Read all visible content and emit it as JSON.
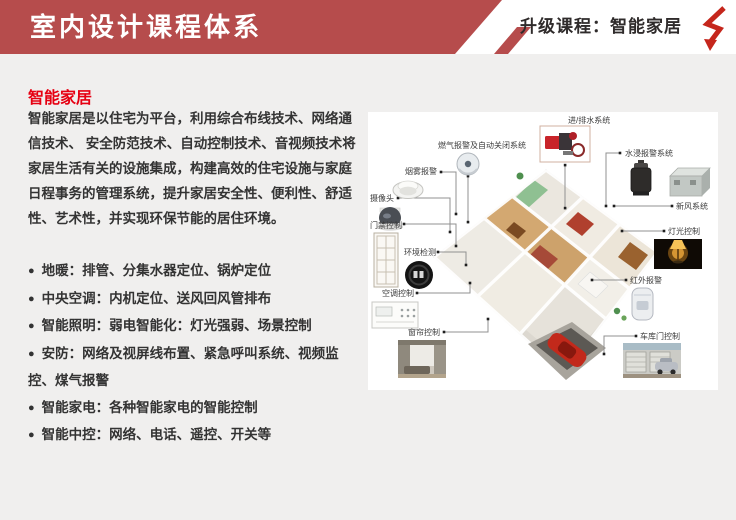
{
  "header": {
    "title": "室内设计课程体系",
    "subtitle": "升级课程：智能家居",
    "logo_icon": "red-zigzag-arrow-icon"
  },
  "content": {
    "heading": "智能家居",
    "paragraph": "智能家居是以住宅为平台，利用综合布线技术、网络通信技术、 安全防范技术、自动控制技术、音视频技术将家居生活有关的设施集成，构建高效的住宅设施与家庭日程事务的管理系统，提升家居安全性、便利性、舒适性、艺术性，并实现环保节能的居住环境。",
    "bullet_char": "●",
    "bullets": [
      "地暖：排管、分集水器定位、锅炉定位",
      "中央空调：内机定位、送风回风管排布",
      "智能照明：弱电智能化：灯光强弱、场景控制",
      "安防：网络及视屏线布置、紧急呼叫系统、视频监控、煤气报警",
      "智能家电：各种智能家电的智能控制",
      "智能中控：网络、电话、遥控、开关等"
    ]
  },
  "diagram": {
    "description": "smart-home-isometric-house",
    "callouts": [
      {
        "id": "water-system",
        "label": "进/排水系统",
        "icon": "water-pump-icon"
      },
      {
        "id": "gas-alarm",
        "label": "燃气报警及自动关闭系统",
        "icon": "gas-sensor-ball-icon"
      },
      {
        "id": "smoke-alarm",
        "label": "烟雾报警",
        "icon": "smoke-detector-icon"
      },
      {
        "id": "camera",
        "label": "摄像头",
        "icon": "dome-camera-icon"
      },
      {
        "id": "door-access",
        "label": "门禁控制",
        "icon": "door-icon"
      },
      {
        "id": "environment",
        "label": "环境检测",
        "icon": "thermostat-icon"
      },
      {
        "id": "ac-control",
        "label": "空调控制",
        "icon": "ac-panel-icon"
      },
      {
        "id": "curtain-control",
        "label": "窗帘控制",
        "icon": "curtain-photo-icon"
      },
      {
        "id": "water-leak",
        "label": "水浸报警系统",
        "icon": "canister-icon"
      },
      {
        "id": "fresh-air",
        "label": "新风系统",
        "icon": "ventilation-unit-icon"
      },
      {
        "id": "light-control",
        "label": "灯光控制",
        "icon": "lamp-photo-icon"
      },
      {
        "id": "infrared-alarm",
        "label": "红外报警",
        "icon": "pir-sensor-icon"
      },
      {
        "id": "garage-door",
        "label": "车库门控制",
        "icon": "garage-photo-icon"
      }
    ]
  },
  "colors": {
    "banner_red": "#b64c4c",
    "logo_red": "#c5261c",
    "heading_red": "#e60012",
    "body_text": "#333333",
    "page_bg": "#f0efee"
  }
}
